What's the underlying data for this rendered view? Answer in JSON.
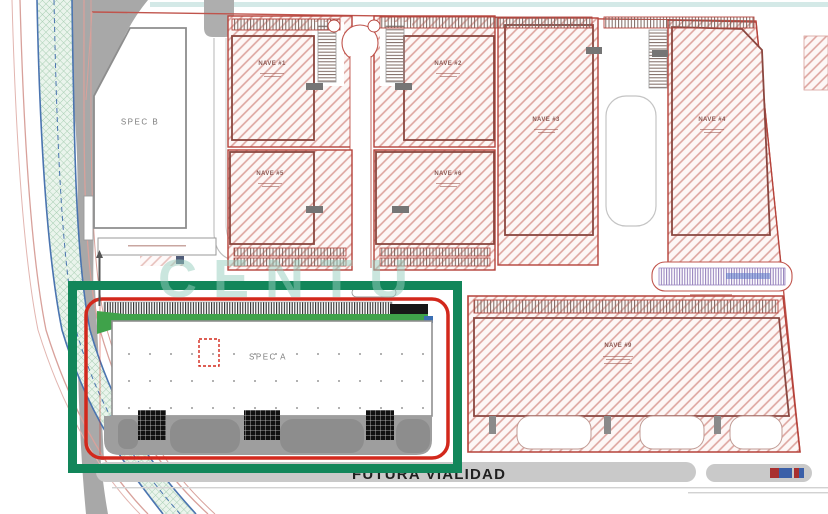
{
  "page": {
    "type": "industrial-park-site-plan",
    "canvas": {
      "width": 828,
      "height": 514
    }
  },
  "labels": {
    "spec_a": "SPEC A",
    "spec_b": "SPEC B",
    "future_road": "FUTURA VIALIDAD",
    "watermark": "CENTU"
  },
  "naves": {
    "row1": [
      "NAVE #1",
      "NAVE #2",
      "NAVE #3",
      "NAVE #4"
    ],
    "row2": [
      "NAVE #5",
      "NAVE #6"
    ],
    "large": "NAVE #9"
  },
  "annotation": {
    "highlighted_building": "SPEC A",
    "highlight_color": "#12865a",
    "parcel_boundary_color": "#d2281c"
  },
  "colors": {
    "hatch_red": "#dda49e",
    "parcel_border": "#b5423a",
    "canal_blue": "#4a74b0",
    "landscape_green": "#3fa24a",
    "road_gray": "#a8a8a8",
    "parking_purple": "#8f7ab8",
    "teal_topline": "#d4e9e7"
  }
}
